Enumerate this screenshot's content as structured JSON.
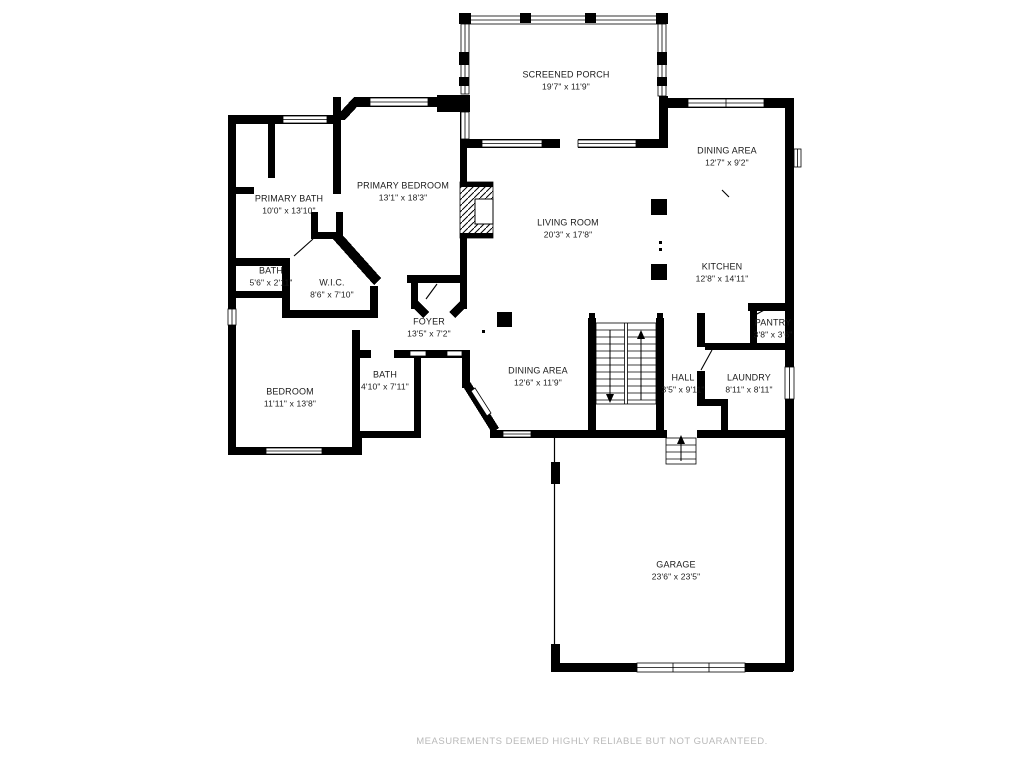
{
  "page": {
    "type": "floor-plan",
    "background_color": "#ffffff",
    "wall_color": "#000000",
    "label_color": "#1b1b1b",
    "footer_color": "#b9b9b9"
  },
  "floor_plan": {
    "rooms": [
      {
        "id": "screened-porch",
        "name": "SCREENED PORCH",
        "dims": "19'7\" x 11'9\""
      },
      {
        "id": "dining-area-upper",
        "name": "DINING AREA",
        "dims": "12'7\" x 9'2\""
      },
      {
        "id": "primary-bedroom",
        "name": "PRIMARY BEDROOM",
        "dims": "13'1\" x 18'3\""
      },
      {
        "id": "primary-bath",
        "name": "PRIMARY BATH",
        "dims": "10'0\" x 13'10\""
      },
      {
        "id": "living-room",
        "name": "LIVING ROOM",
        "dims": "20'3\" x 17'8\""
      },
      {
        "id": "kitchen",
        "name": "KITCHEN",
        "dims": "12'8\" x 14'11\""
      },
      {
        "id": "bath-hall",
        "name": "BATH",
        "dims": "5'6\" x 2'11\""
      },
      {
        "id": "wic",
        "name": "W.I.C.",
        "dims": "8'6\" x 7'10\""
      },
      {
        "id": "foyer",
        "name": "FOYER",
        "dims": "13'5\" x 7'2\""
      },
      {
        "id": "pantry",
        "name": "PANTRY",
        "dims": "3'8\" x 3'6\""
      },
      {
        "id": "dining-area-lower",
        "name": "DINING AREA",
        "dims": "12'6\" x 11'9\""
      },
      {
        "id": "hall",
        "name": "HALL",
        "dims": "3'5\" x 9'11\""
      },
      {
        "id": "laundry",
        "name": "LAUNDRY",
        "dims": "8'11\" x 8'11\""
      },
      {
        "id": "bedroom",
        "name": "BEDROOM",
        "dims": "11'11\" x 13'8\""
      },
      {
        "id": "bath-2",
        "name": "BATH",
        "dims": "4'10\" x 7'11\""
      },
      {
        "id": "garage",
        "name": "GARAGE",
        "dims": "23'6\" x 23'5\""
      }
    ],
    "features": [
      "staircase-up-down",
      "garage-steps",
      "fireplace",
      "screened-porch-posts",
      "garage-door",
      "front-entry"
    ]
  },
  "footer": {
    "disclaimer": "MEASUREMENTS DEEMED HIGHLY RELIABLE BUT NOT GUARANTEED."
  }
}
